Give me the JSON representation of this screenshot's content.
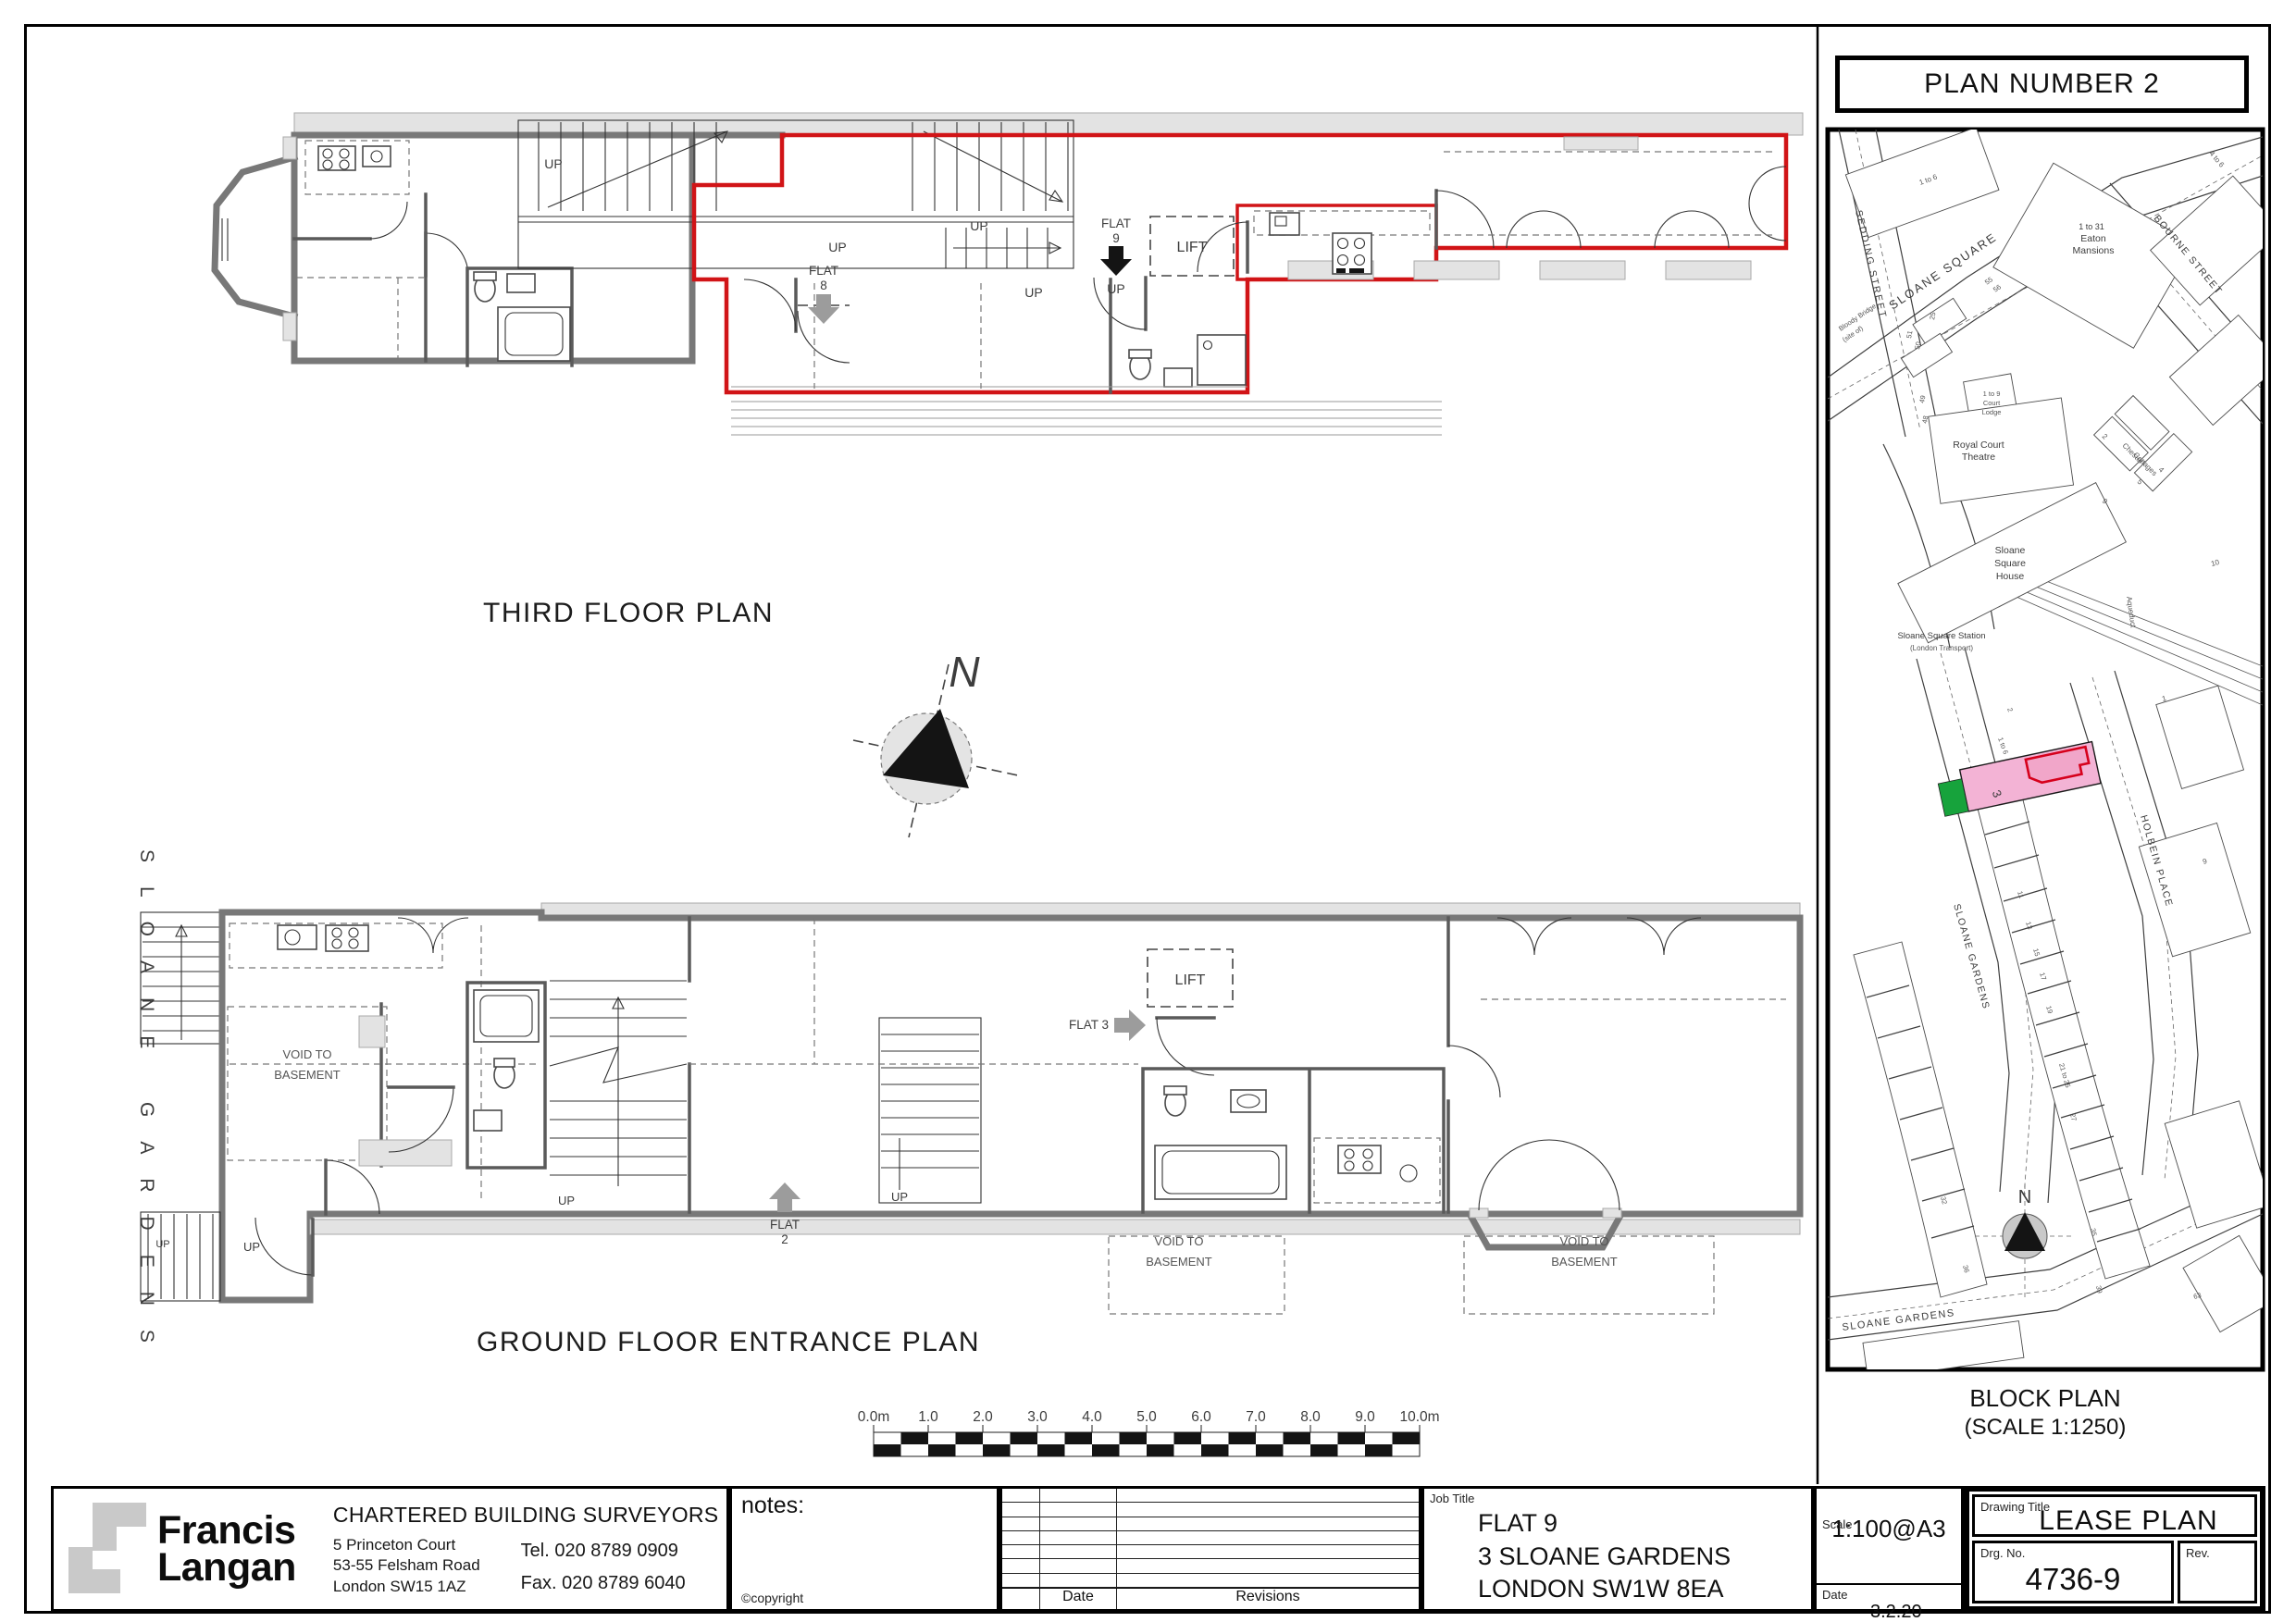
{
  "colors": {
    "lease_red": "#d11417",
    "subject_pink": "#f3b3d5",
    "subject_green": "#17a33c"
  },
  "panel": {
    "title": "PLAN NUMBER 2",
    "caption_line1": "BLOCK PLAN",
    "caption_line2": "(SCALE 1:1250)"
  },
  "labels": {
    "up": "UP",
    "lift": "LIFT",
    "flat": "FLAT",
    "flat9_no": "9",
    "flat8_no": "8",
    "flat2_no": "2",
    "flat3": "FLAT 3",
    "void_line1": "VOID TO",
    "void_line2": "BASEMENT",
    "north": "N"
  },
  "captions": {
    "third_floor": "THIRD FLOOR PLAN",
    "ground_floor": "GROUND FLOOR ENTRANCE PLAN",
    "side_street": "SLOANE GARDENS"
  },
  "scale_bar": {
    "ticks": [
      "0.0m",
      "1.0",
      "2.0",
      "3.0",
      "4.0",
      "5.0",
      "6.0",
      "7.0",
      "8.0",
      "9.0",
      "10.0m"
    ]
  },
  "map": {
    "streets": {
      "sedding": "SEDDING STREET",
      "sloane_square": "SLOANE SQUARE",
      "bourne": "BOURNE STREET",
      "holbein": "HOLBEIN PLACE",
      "sloane_gardens": "SLOANE GARDENS",
      "sloane_gardens2": "SLOANE GARDENS"
    },
    "places": {
      "bloody1": "Bloody Bridge",
      "bloody2": "(site of)",
      "eaton1": "1 to 31",
      "eaton2": "Eaton",
      "eaton3": "Mansions",
      "court1": "1 to 9",
      "court2": "Court",
      "court3": "Lodge",
      "royal1": "Royal Court",
      "royal2": "Theatre",
      "chester1": "Chester",
      "chester2": "Cottages",
      "ssh1": "Sloane",
      "ssh2": "Square",
      "ssh3": "House",
      "station1": "Sloane Square Station",
      "station2": "(London Transport)",
      "aqueduct": "Aqueduct"
    },
    "numbers": {
      "n1to6a": "1 to 6",
      "n1to6b": "1 to 6",
      "n4to6": "4 to 6",
      "n55": "55",
      "n56": "56",
      "n25": "25",
      "n51": "51",
      "n50": "50",
      "n49": "49",
      "n48": "48",
      "n2a": "2",
      "n2b": "2",
      "n5": "5",
      "n4": "4",
      "n9a": "9",
      "n9b": "9",
      "n10": "10",
      "n1": "1",
      "subject": "3",
      "n11": "11",
      "n13": "13",
      "n15": "15",
      "n17": "17",
      "n19": "19",
      "n21to25": "21 to 25",
      "n27": "27",
      "n32": "32",
      "n35": "35",
      "n36": "36",
      "n39": "39",
      "n63": "63"
    },
    "north": "N"
  },
  "title_block": {
    "name1": "Francis",
    "name2": "Langan",
    "firm": "CHARTERED BUILDING SURVEYORS",
    "addr1": "5 Princeton Court",
    "addr2": "53-55 Felsham Road",
    "addr3": "London SW15 1AZ",
    "tel": "Tel. 020 8789 0909",
    "fax": "Fax. 020 8789 6040",
    "notes": "notes:",
    "copyright": "©copyright",
    "date_col": "Date",
    "revisions_col": "Revisions",
    "job_label": "Job Title",
    "job1": "FLAT 9",
    "job2": "3 SLOANE GARDENS",
    "job3": "LONDON SW1W 8EA",
    "scale_label": "Scale",
    "scale": "1:100@A3",
    "date_label": "Date",
    "date": "3.2.20",
    "drawing_label": "Drawing Title",
    "drawing_title": "LEASE PLAN",
    "drg_label": "Drg. No.",
    "drg_no": "4736-9",
    "rev_label": "Rev."
  }
}
